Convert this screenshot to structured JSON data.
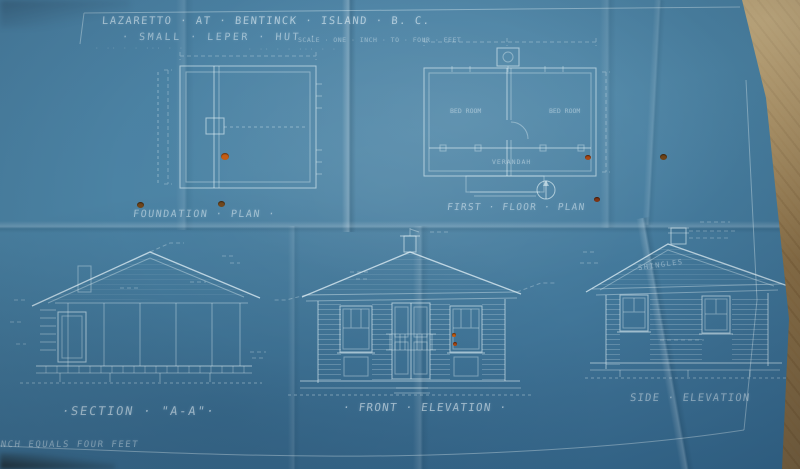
{
  "photo": {
    "description": "photograph of a cyanotype architectural blueprint lying on a wooden table",
    "colors": {
      "wood": "#ab905f",
      "paper_blue": "#4a80a2",
      "paper_blue_dark": "#356a90",
      "line_white": "#eaf6fa",
      "hole_orange": "#c25a10",
      "hole_brown": "#6e4419"
    }
  },
  "titleblock": {
    "line1": "LAZARETTO · AT · BENTINCK · ISLAND · B. C.",
    "line2": "· SMALL · LEPER · HUT ·",
    "scale_note": "SCALE · ONE · INCH · TO · FOUR · FEET",
    "subnote": "· ·· · · ··· · ·"
  },
  "drawings": {
    "foundation_plan": {
      "label": "FOUNDATION · PLAN ·"
    },
    "first_floor_plan": {
      "label": "FIRST · FLOOR · PLAN",
      "rooms": [
        "BED ROOM",
        "BED ROOM",
        "VERANDAH"
      ]
    },
    "section": {
      "label": "·SECTION · \"A-A\"·"
    },
    "front_elevation": {
      "label": "· FRONT · ELEVATION ·"
    },
    "side_elevation": {
      "label": "SIDE · ELEVATION",
      "roof_note": "SHINGLES"
    }
  },
  "footer": {
    "scale_footnote": "ONE INCH EQUALS FOUR FEET"
  }
}
